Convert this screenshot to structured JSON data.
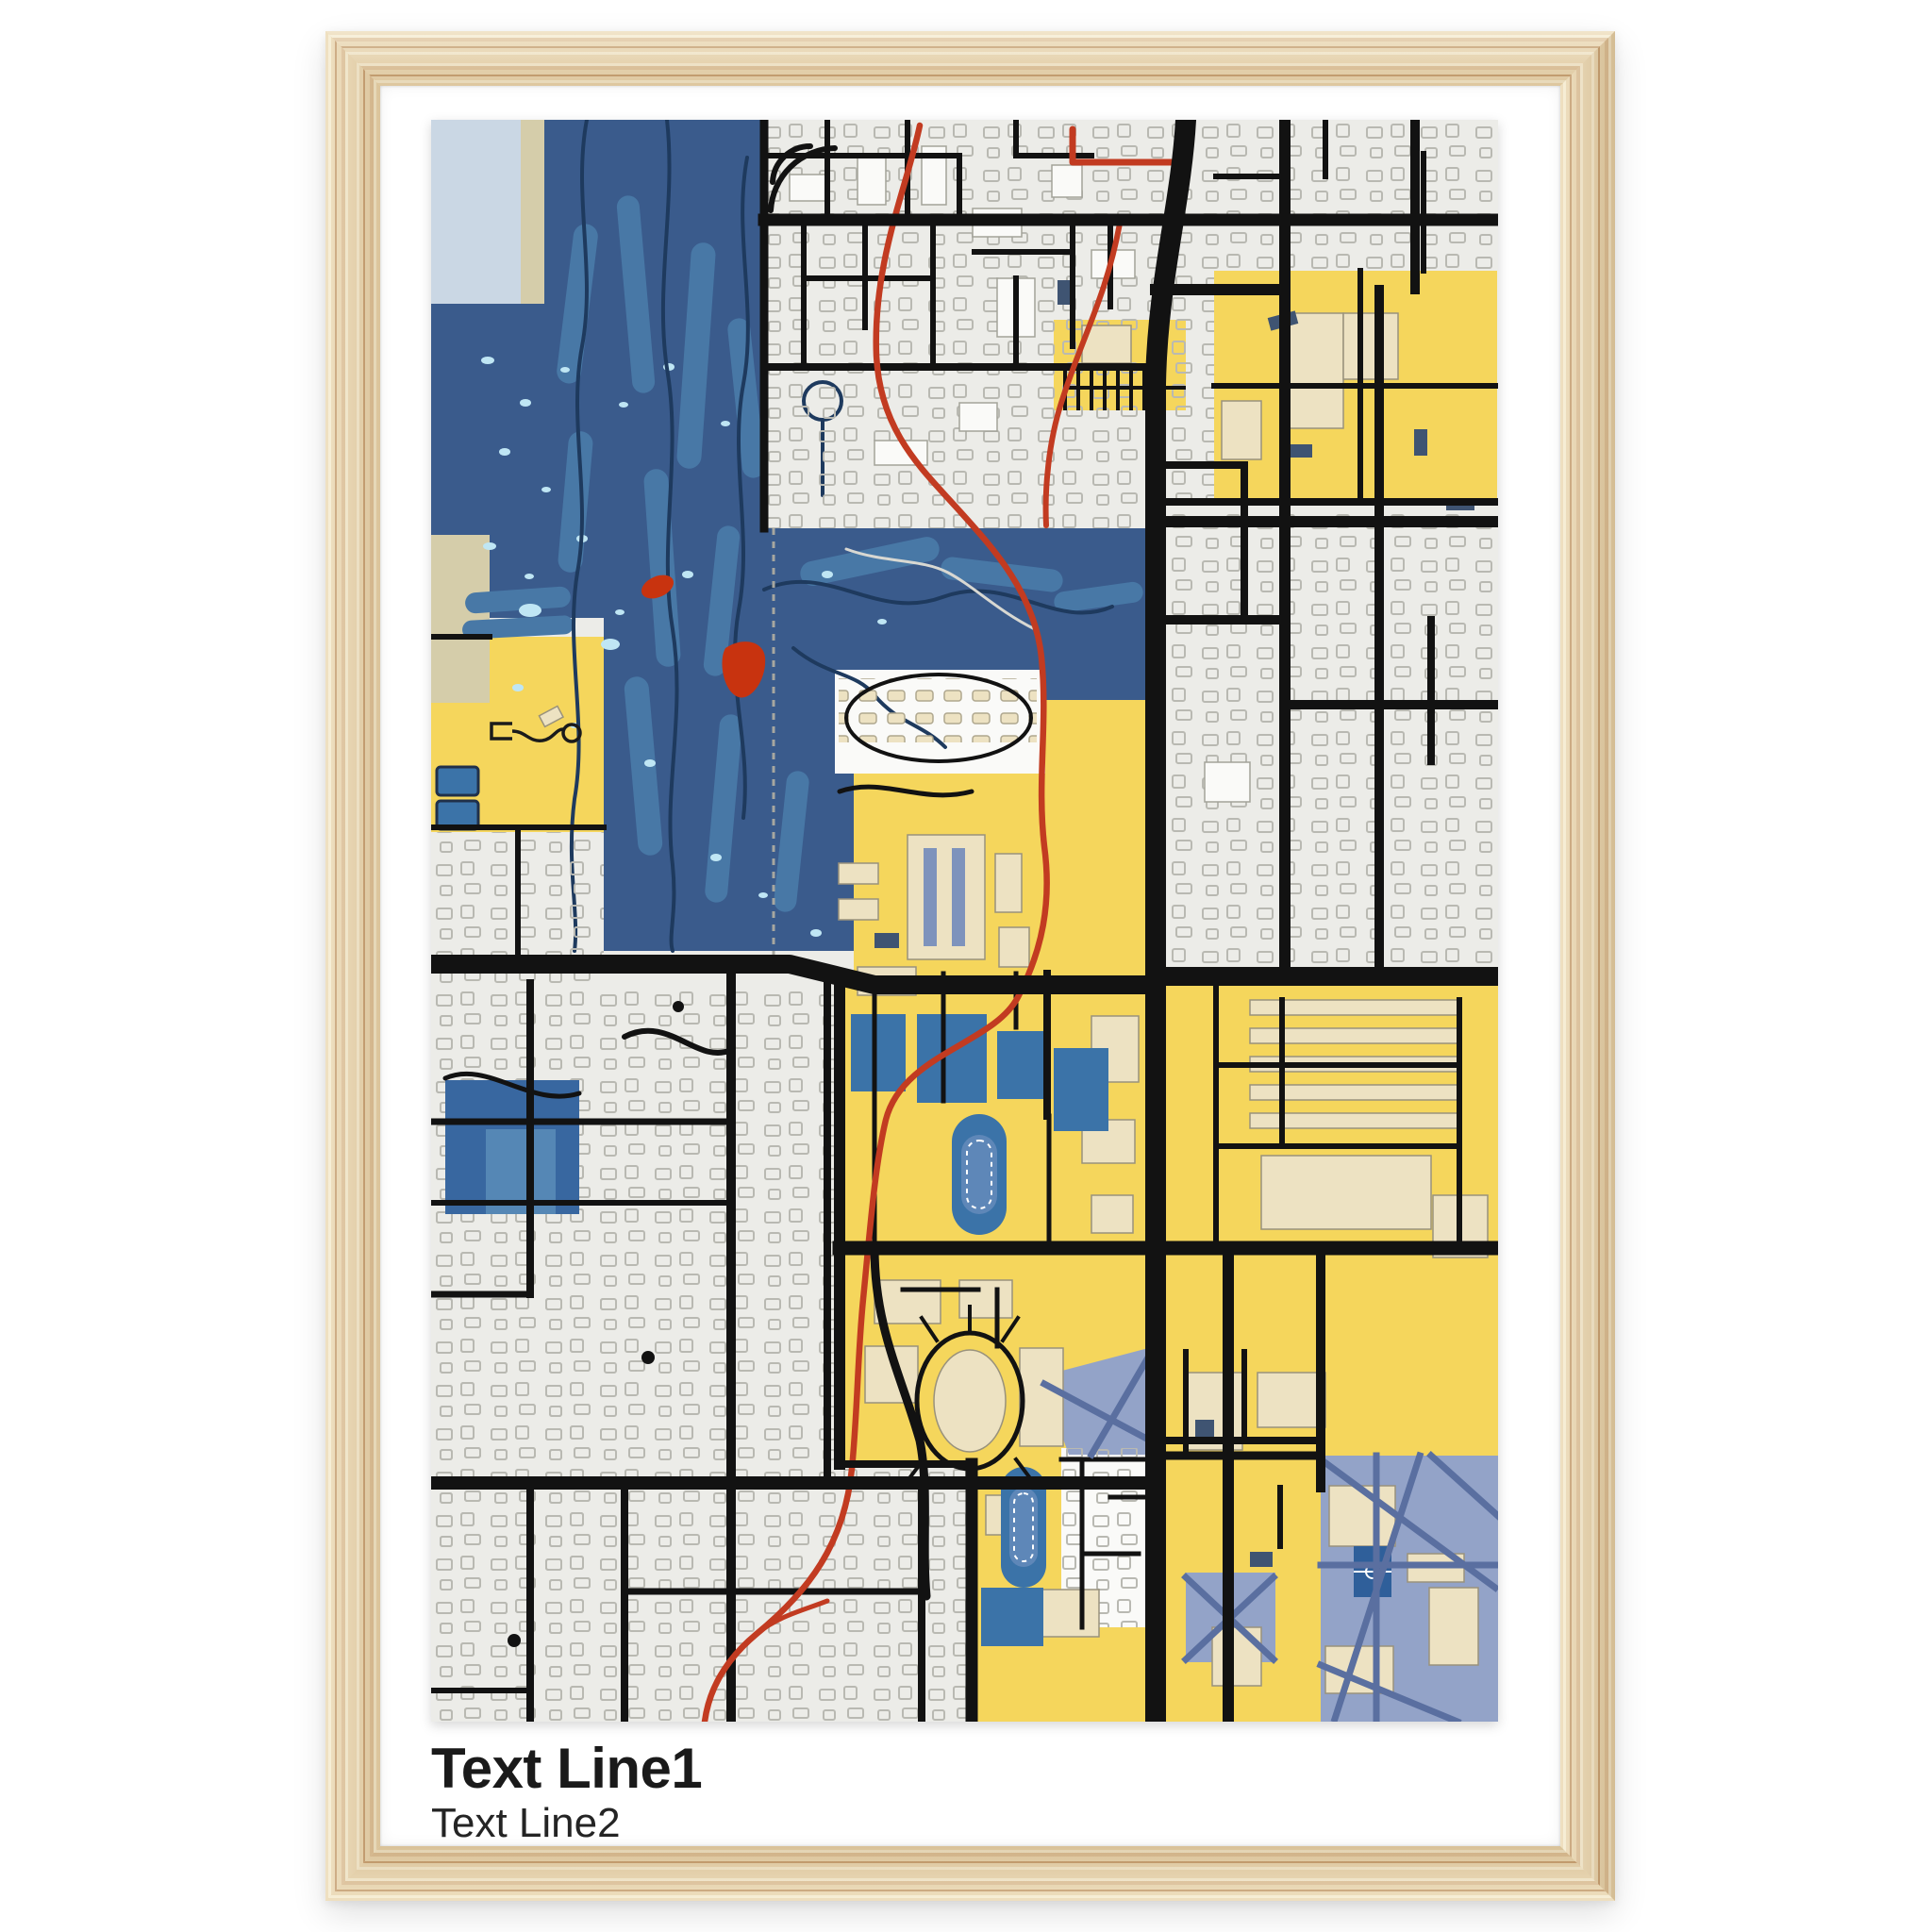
{
  "poster": {
    "title_line1": "Text Line1",
    "title_line2": "Text Line2"
  },
  "frame": {
    "material": "natural wood grain",
    "mat_color": "#FFFFFF"
  },
  "map": {
    "style": "college-colors street map print",
    "palette": {
      "background": "#ECECE8",
      "park_navy": "#3A5B8C",
      "fairway": "#4878A6",
      "water_speck": "#BFE6F4",
      "pale_block": "#CAD7E4",
      "khaki_block": "#D5CDAA",
      "campus_yellow": "#F5D65C",
      "building_cream": "#EDE2C2",
      "building_white": "#FAFAF8",
      "plaza_periwinkle": "#93A3C8",
      "plaza_path": "#5A6FA0",
      "field_blue": "#3B73A8",
      "pond_blue": "#3867A0",
      "pond_inner": "#5587B5",
      "house_outline": "#B9B9B2",
      "road_black": "#121212",
      "trail_red": "#C23B21",
      "pond_red": "#C8330F",
      "railroad_gray": "#A7A7A0",
      "cartpath_navy": "#1E3A5E",
      "accent_slate": "#3F5472"
    }
  },
  "wood": {
    "base": "#EBD8B1",
    "light": "#F6ECCF",
    "mid": "#DFC39A",
    "dark": "#C69E6F"
  }
}
